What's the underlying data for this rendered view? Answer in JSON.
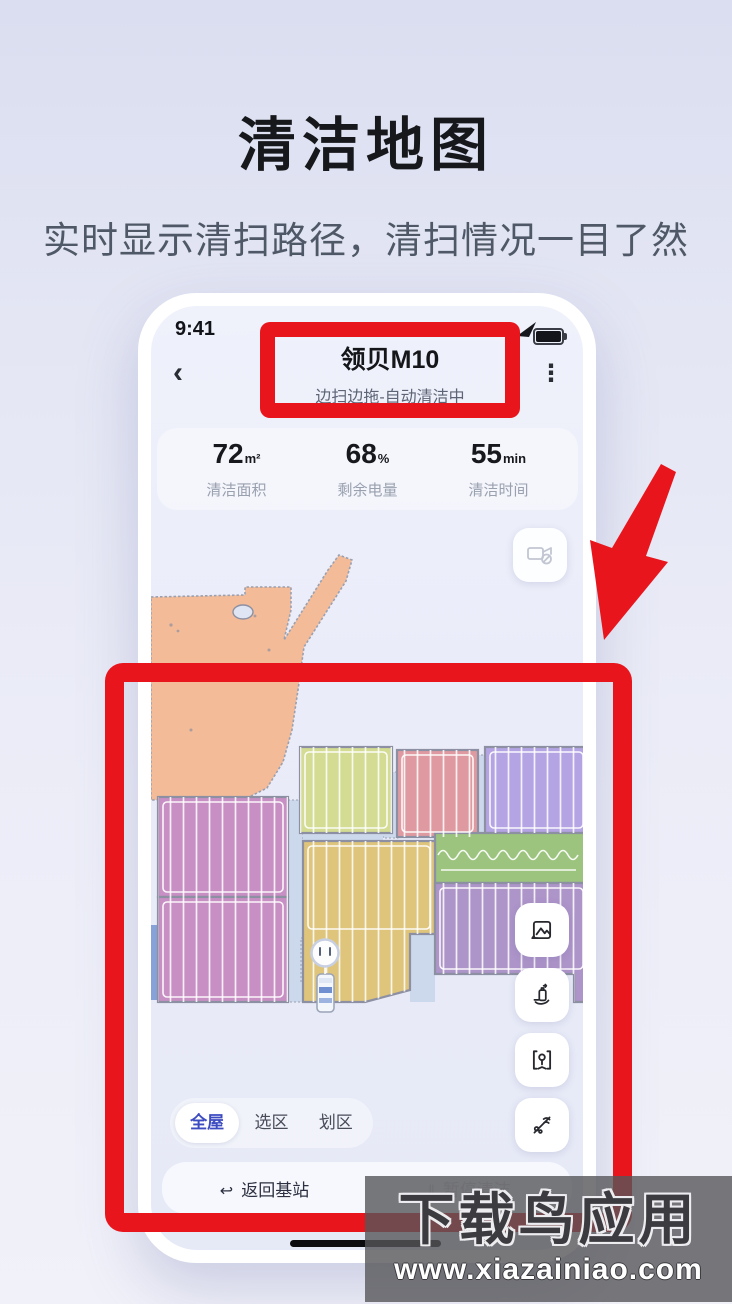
{
  "hero": {
    "title": "清洁地图",
    "subtitle": "实时显示清扫路径，清扫情况一目了然"
  },
  "phone": {
    "status_bar": {
      "time": "9:41",
      "battery_icon": "battery-full"
    },
    "header": {
      "back_glyph": "‹",
      "device_name": "领贝M10",
      "status_text": "边扫边拖-自动清洁中",
      "menu_glyph": "⋮"
    },
    "stats": [
      {
        "value": "72",
        "unit": "m²",
        "label": "清洁面积"
      },
      {
        "value": "68",
        "unit": "%",
        "label": "剩余电量"
      },
      {
        "value": "55",
        "unit": "min",
        "label": "清洁时间"
      }
    ],
    "camera_button": {
      "icon": "video-camera-off"
    },
    "side_buttons": [
      {
        "icon": "photo"
      },
      {
        "icon": "detergent-dispense"
      },
      {
        "icon": "map-manage"
      },
      {
        "icon": "water-flow"
      }
    ],
    "mode_tabs": {
      "selected": "全屋",
      "tabs": [
        "全屋",
        "选区",
        "划区"
      ]
    },
    "bottom_actions": {
      "return_glyph": "↩",
      "return_label": "返回基站",
      "pause_glyph": "‖",
      "pause_label": "暂停清洁"
    }
  },
  "map": {
    "robot_icon": "robot",
    "dock_icon": "dock-station",
    "room_colors": [
      "#f3bb97",
      "#d3dc92",
      "#df9aa1",
      "#b4a4e4",
      "#c78fc3",
      "#dfc47b",
      "#9cc47e",
      "#ad94c9"
    ],
    "corridor_color": "#ccd9ec",
    "wall_color": "#8d90a2"
  },
  "annotations": {
    "accent_red": "#e8161c"
  },
  "watermark": {
    "line1": "下载鸟应用",
    "line2": "www.xiazainiao.com"
  }
}
